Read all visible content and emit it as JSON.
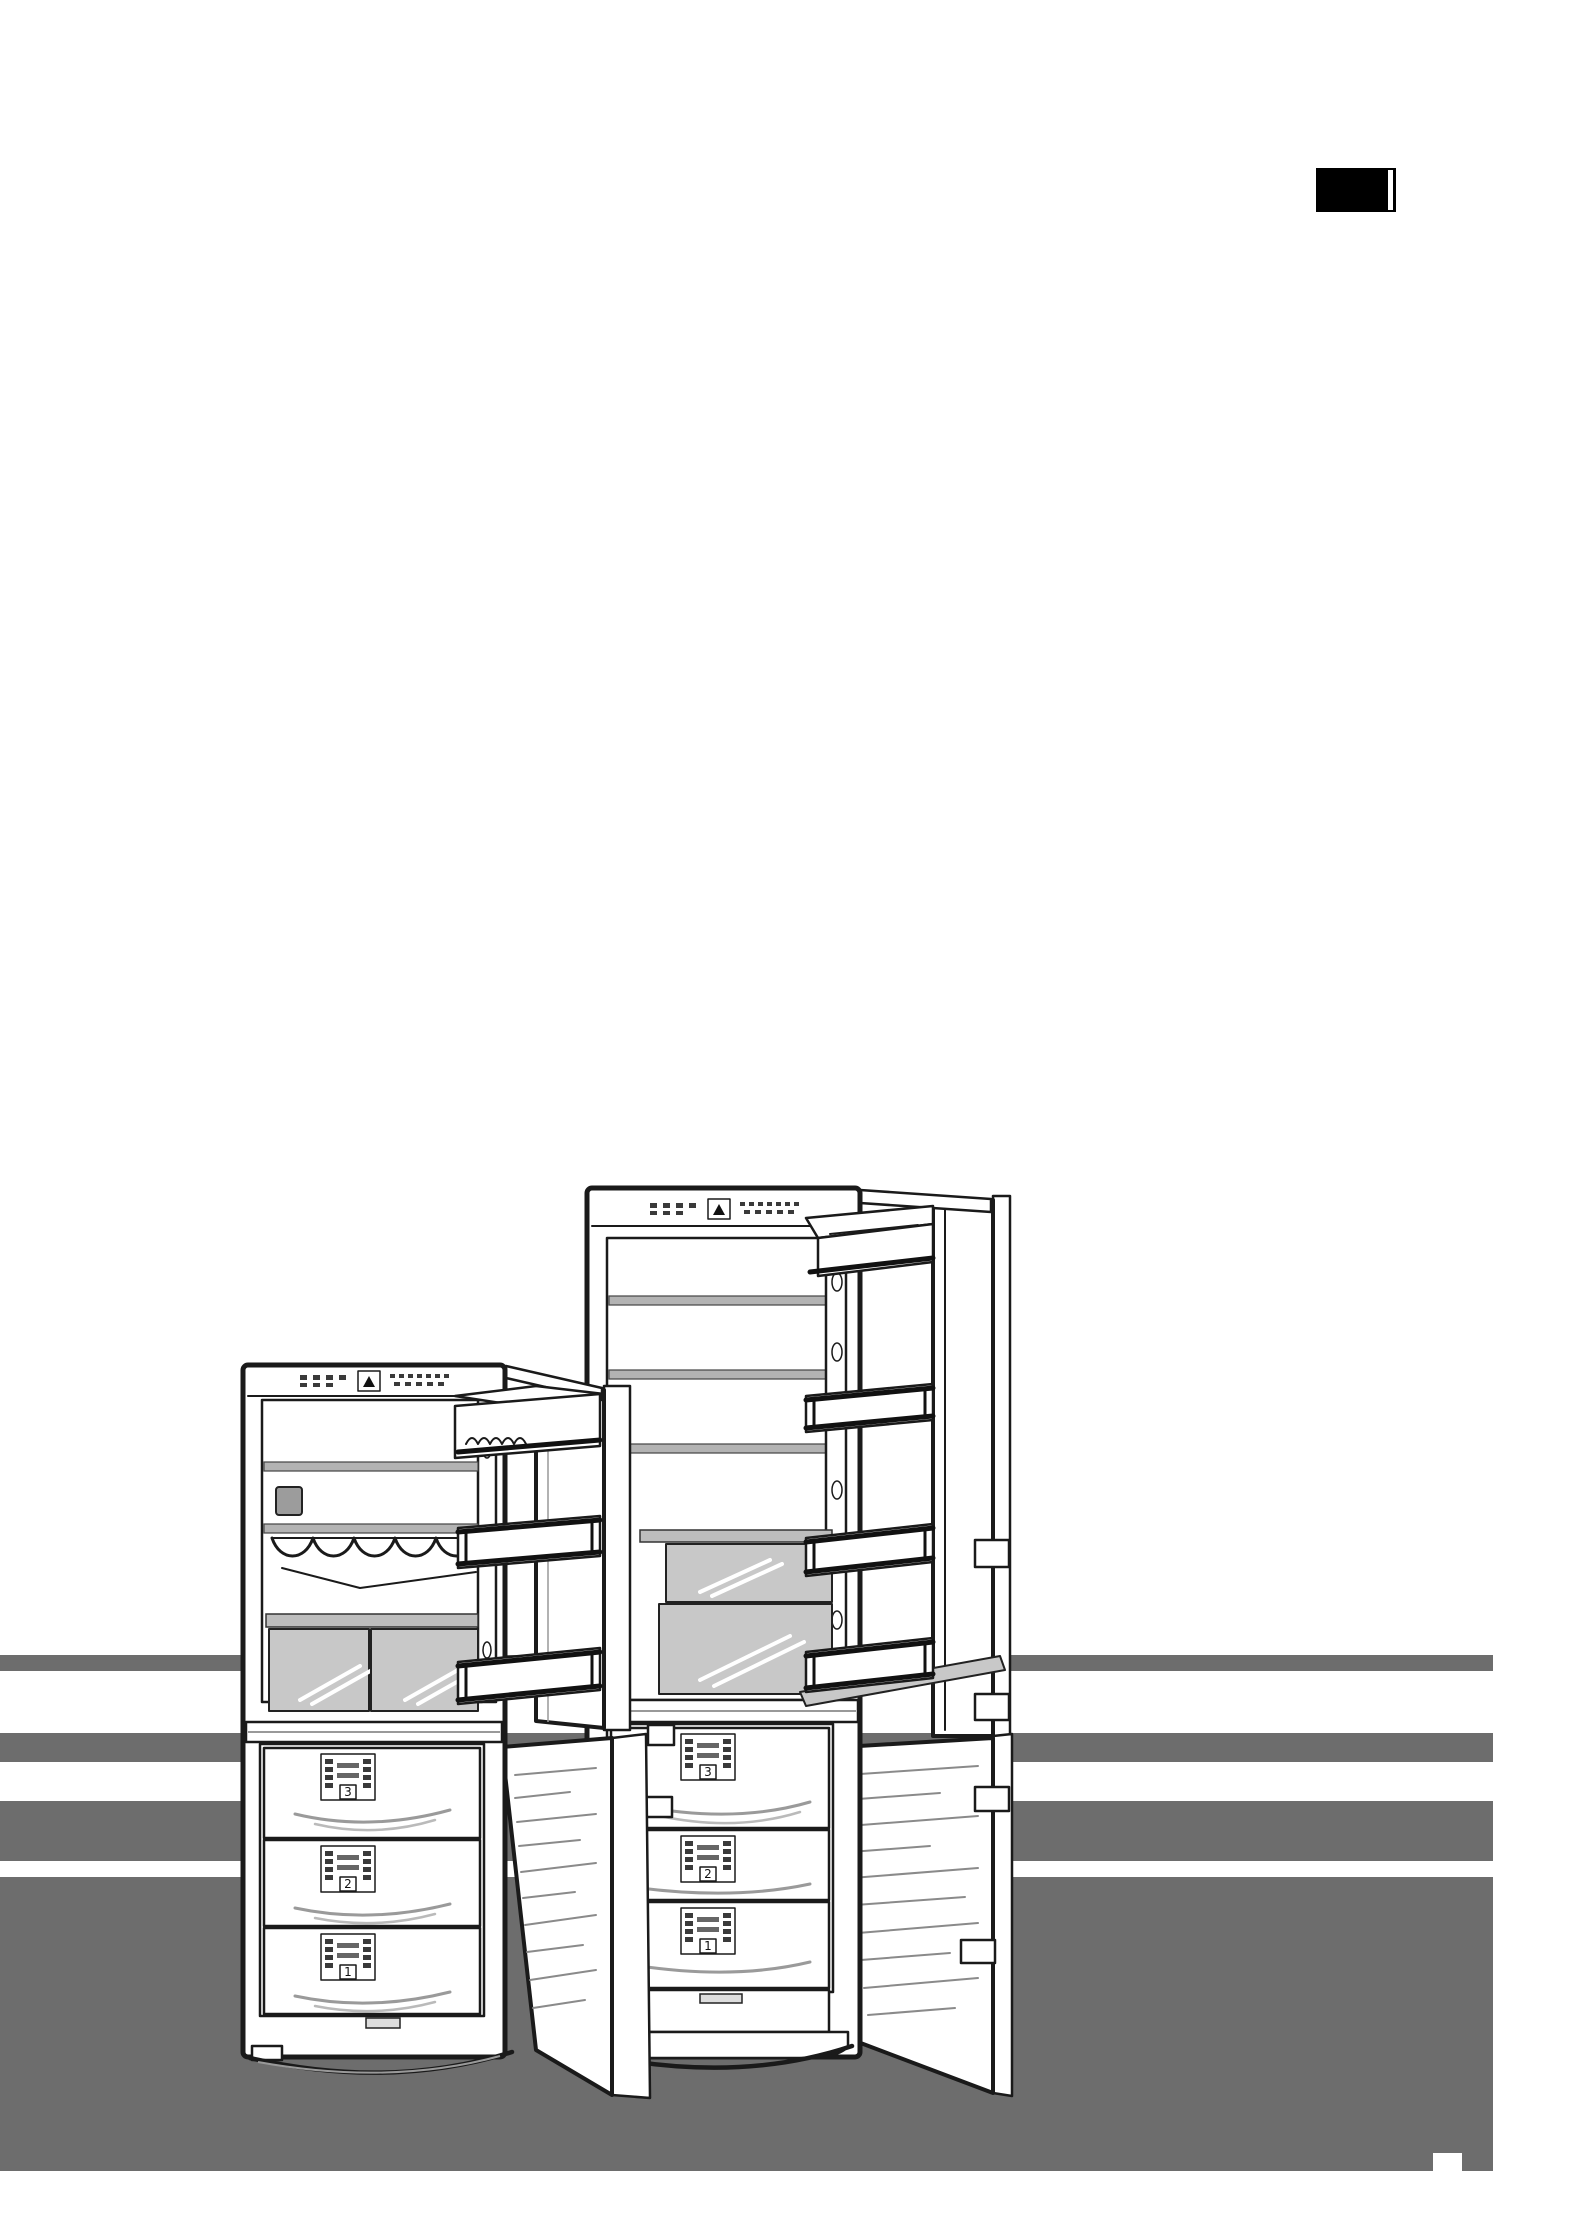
{
  "page": {
    "background_color": "#ffffff"
  },
  "language_tab": {
    "bg_color": "#000000",
    "stripe_color": "#ffffff"
  },
  "background_stripes": {
    "color": "#6d6d6d"
  },
  "illustration": {
    "left_fridge": {
      "drawer_labels": [
        "3",
        "2",
        "1"
      ]
    },
    "right_fridge": {
      "drawer_labels": [
        "3",
        "2",
        "1"
      ]
    }
  },
  "colors": {
    "outline": "#1a1a1a",
    "shelf_gray": "#b3b3b3",
    "crisper_gray": "#c8c8c8",
    "floor_gray": "#6d6d6d"
  }
}
